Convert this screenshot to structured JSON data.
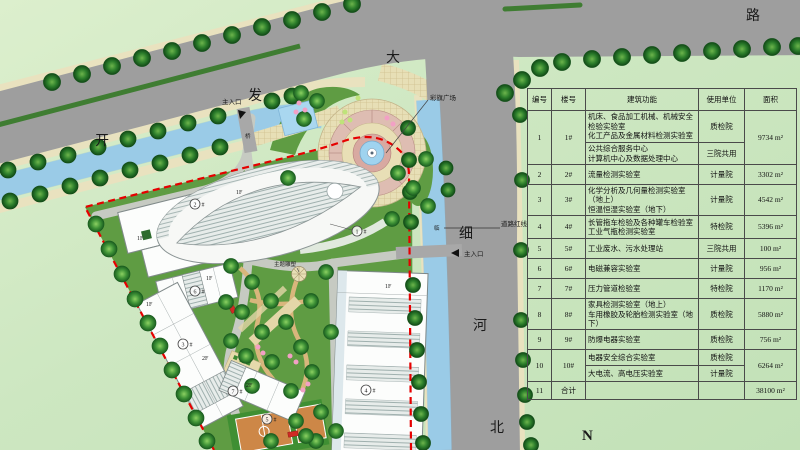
{
  "map": {
    "road_names": {
      "kai": "开",
      "fa": "发",
      "da": "大",
      "lu": "路",
      "xi": "细",
      "he": "河",
      "bei": "北"
    },
    "labels": {
      "main_entrance_top": "主入口",
      "main_entrance_side": "主入口",
      "road_red_line": "道路红线",
      "flag_plaza": "彩旗广场",
      "theme_sculpture": "主题雕塑",
      "bridge": "桥",
      "canal": "临",
      "north": "N"
    },
    "bldg_nums": [
      "1",
      "2",
      "3",
      "4",
      "5",
      "6",
      "7"
    ],
    "hash": "#",
    "floors": [
      "1F",
      "1F",
      "1F",
      "1F",
      "1F",
      "2F",
      "2F"
    ]
  },
  "table": {
    "headers": [
      "编号",
      "楼号",
      "建筑功能",
      "使用单位",
      "面积"
    ],
    "rows": [
      {
        "no": "1",
        "bldg": "1#",
        "func_a": "机床、食品加工机械、机械安全检验实验室\n化工产品及金属材料检测实验室",
        "unit_a": "质检院",
        "func_b": "公共综合服务中心\n计算机中心及数据处理中心",
        "unit_b": "三院共用",
        "area": "9734 m²"
      },
      {
        "no": "2",
        "bldg": "2#",
        "func": "流量检测实验室",
        "unit": "计量院",
        "area": "3302 m²"
      },
      {
        "no": "3",
        "bldg": "3#",
        "func": "化学分析及几何量检测实验室（地上）\n恒温恒湿实验室（地下）",
        "unit": "计量院",
        "area": "4542 m²"
      },
      {
        "no": "4",
        "bldg": "4#",
        "func": "长管拖车检验及各种罐车检验室\n工业气瓶检测实验室",
        "unit": "特检院",
        "area": "5396 m²"
      },
      {
        "no": "5",
        "bldg": "5#",
        "func": "工业废水、污水处理站",
        "unit": "三院共用",
        "area": "100 m²"
      },
      {
        "no": "6",
        "bldg": "6#",
        "func": "电磁兼容实验室",
        "unit": "计量院",
        "area": "956 m²"
      },
      {
        "no": "7",
        "bldg": "7#",
        "func": "压力管道检验室",
        "unit": "特检院",
        "area": "1170 m²"
      },
      {
        "no": "8",
        "bldg": "8#",
        "func": "家具检测实验室（地上）\n车用橡胶及轮胎检测实验室（地下）",
        "unit": "质检院",
        "area": "5880 m²"
      },
      {
        "no": "9",
        "bldg": "9#",
        "func": "防爆电器实验室",
        "unit": "质检院",
        "area": "756 m²"
      },
      {
        "no": "10",
        "bldg": "10#",
        "func_a": "电器安全综合实验室",
        "unit_a": "质检院",
        "func_b": "大电流、高电压实验室",
        "unit_b": "计量院",
        "area": "6264 m²"
      },
      {
        "no": "11",
        "bldg": "合计",
        "func": "",
        "unit": "",
        "area": "38100 m²"
      }
    ]
  },
  "colors": {
    "boundary_red": "#e60000",
    "road_gray": "#9e9e9e",
    "water_blue": "#a9d7f0",
    "lawn_green": "#5f9c43",
    "bg_green": "#cde7c2",
    "court_orange": "#cd8747"
  }
}
